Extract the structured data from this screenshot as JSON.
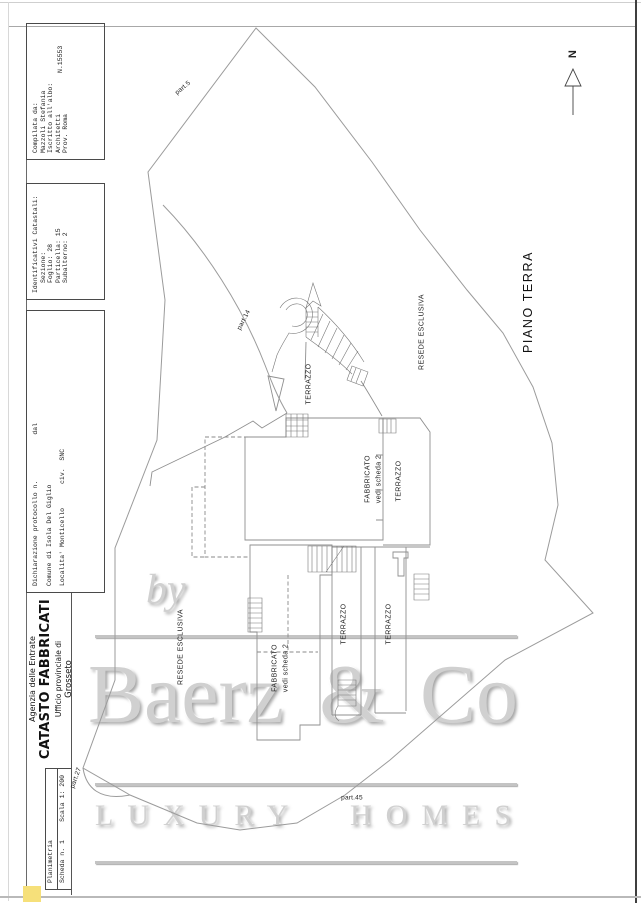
{
  "header": {
    "planimetria": {
      "title": "Planimetria",
      "scheda": "Scheda n. 1",
      "scala": "Scala 1: 200"
    },
    "agency": {
      "entity": "Agenzia delle Entrate",
      "office": "CATASTO FABBRICATI",
      "sub": "Ufficio provinciale di",
      "city": "Grosseto"
    },
    "dichiarazione": {
      "protocollo": "Dichiarazione protocollo n.",
      "dal": "dal",
      "comune": "Comune di Isola Del Giglio",
      "localita": "Localita' Monticello",
      "civ": "civ.  SNC"
    },
    "identificativi": {
      "title": "Identificativi Catastali:",
      "sezione": "Sezione:",
      "foglio": "Foglio: 28",
      "particella": "Particella: 15",
      "subalterno": "Subalterno: 2"
    },
    "compilata": {
      "line1": "Compilata da:",
      "line2": "Mazzoli Stefania",
      "line3": "Iscritto all'albo:",
      "line4": "Architetti",
      "line5": "Prov. Roma",
      "number": "N.15553"
    }
  },
  "plan": {
    "north": "N",
    "floor": "PIANO TERRA",
    "terrazzo": "TERRAZZO",
    "resede": "RESEDE ESCLUSIVA",
    "fabbricato_line1": "FABBRICATO",
    "fabbricato_line2": "vedi scheda 2",
    "part5": "part.5",
    "part14": "part.14",
    "part27": "part.27",
    "part45": "part.45"
  },
  "watermark": {
    "by": "by",
    "brand": [
      "Baerz",
      "&",
      "Co"
    ],
    "tagline": [
      "LUXURY",
      "HOMES"
    ]
  },
  "colors": {
    "highlight_chip": "#f6e07a",
    "plan_line": "#8f8f8f",
    "watermark_gray": "#d0d0d0",
    "page_edge_dark": "#3f3f3f"
  }
}
